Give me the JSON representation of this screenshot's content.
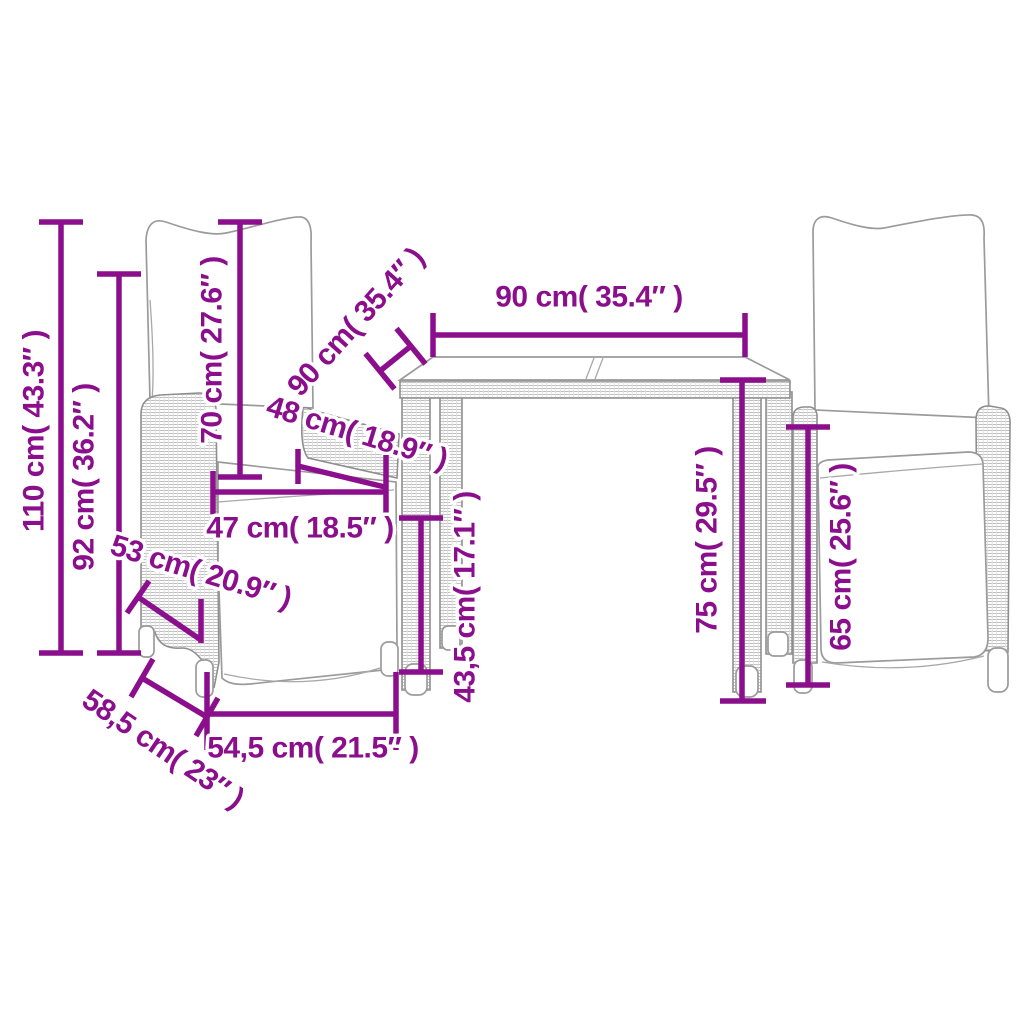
{
  "diagram": {
    "accent_color": "#8B0E8C",
    "artwork_line_color": "#9B9B9B",
    "dimensions": {
      "total_height": "110 cm( 43.3″ )",
      "backrest_height": "92 cm( 36.2″ )",
      "back_cushion_height": "70 cm( 27.6″ )",
      "table_depth": "90 cm( 35.4″ )",
      "table_width": "90 cm( 35.4″ )",
      "armrest_depth": "48 cm( 18.9″ )",
      "seat_width": "47 cm( 18.5″ )",
      "seat_depth": "53 cm( 20.9″ )",
      "seat_height": "43,5 cm( 17.1″ )",
      "table_height": "75 cm( 29.5″ )",
      "armrest_height": "65 cm( 25.6″ )",
      "chair_base_depth": "58,5 cm( 23″ )",
      "chair_base_width": "54,5 cm( 21.5″ )"
    }
  }
}
